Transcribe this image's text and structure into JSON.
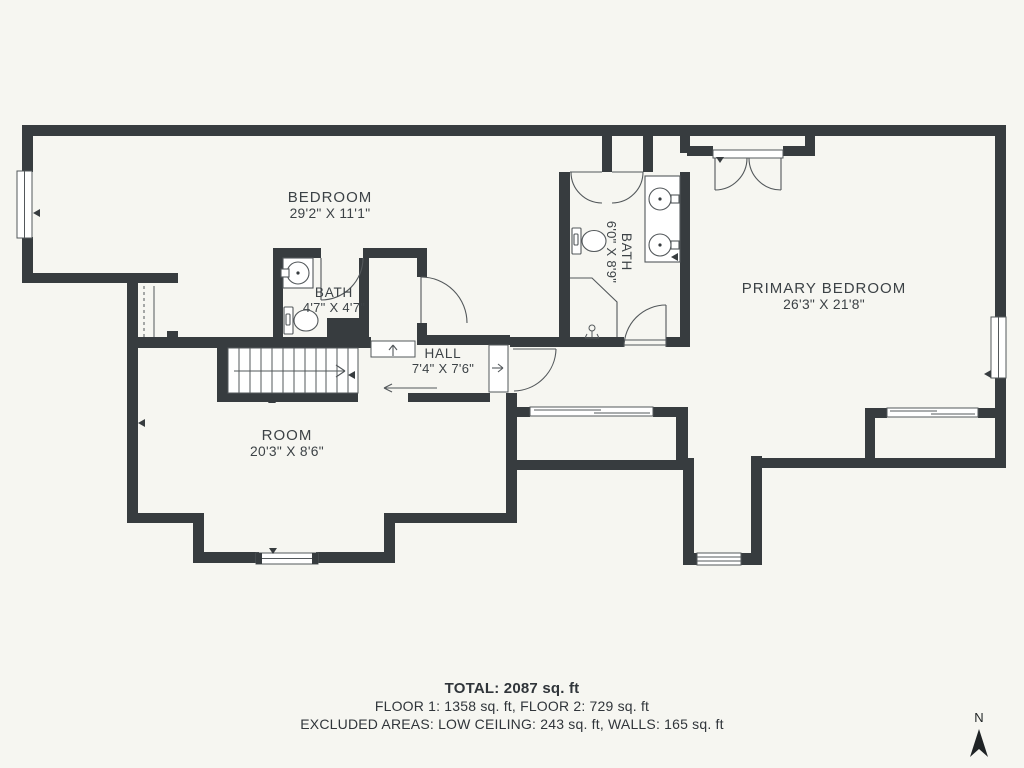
{
  "rooms": [
    {
      "id": "bedroom",
      "label": "BEDROOM",
      "dims": "29'2\" X 11'1\""
    },
    {
      "id": "bath-small",
      "label": "BATH",
      "dims": "4'7\" X 4'7\""
    },
    {
      "id": "bath-primary",
      "label": "BATH",
      "dims": "6'0\" X 8'9\""
    },
    {
      "id": "hall",
      "label": "HALL",
      "dims": "7'4\" X 7'6\""
    },
    {
      "id": "primary-bedroom",
      "label": "PRIMARY BEDROOM",
      "dims": "26'3\" X 21'8\""
    },
    {
      "id": "room",
      "label": "ROOM",
      "dims": "20'3\" X 8'6\""
    }
  ],
  "summary": {
    "total": "TOTAL: 2087 sq. ft",
    "floors": "FLOOR 1: 1358 sq. ft, FLOOR 2: 729 sq. ft",
    "excluded": "EXCLUDED AREAS: LOW CEILING: 243 sq. ft, WALLS: 165 sq. ft"
  },
  "compass": {
    "label": "N"
  },
  "colors": {
    "wall": "#373c3f",
    "background": "#f6f6f1",
    "line": "#53585b",
    "text": "#3c4246",
    "window_fill": "#ffffff"
  }
}
